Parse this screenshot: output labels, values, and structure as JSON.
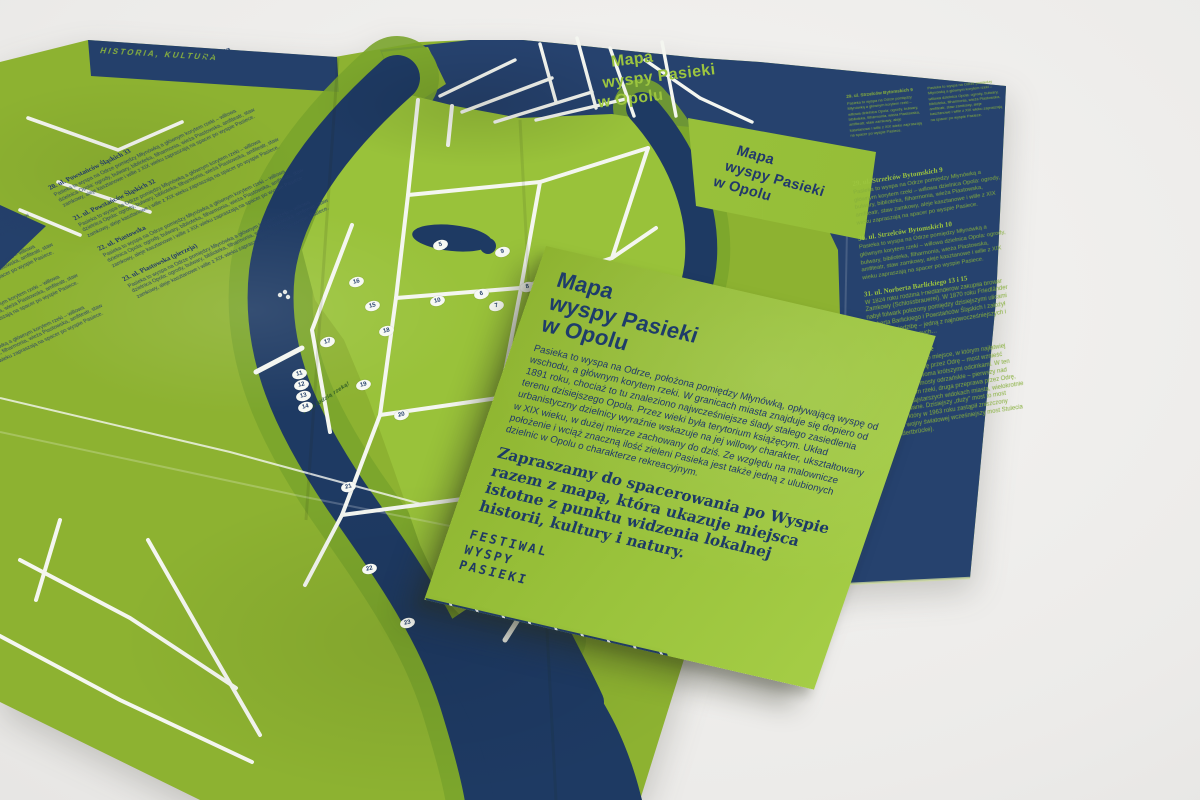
{
  "scene": {
    "background": "#ecebe9",
    "paper_green": "#8db231",
    "paper_green_bright": "#9ac33c",
    "paper_navy": "#24406b",
    "river_navy": "#1e3a63",
    "road_white": "#f4f6f0",
    "text_navy": "#1d3a66",
    "text_green": "#9cc53f"
  },
  "big_map": {
    "spine_heading": "HISTORIA, KULTURA",
    "natura_heading": "Natura",
    "back_title": {
      "l1": "Mapa",
      "l2": "wyspy Pasieki",
      "l3": "w Opolu"
    },
    "river_note": "Płyń łodzią rzeką!",
    "micro_text": "Pasieka to wyspa na Odrze pomiędzy Młynówką a głównym korytem rzeki – willowa dzielnica Opola: ogrody, bulwary, biblioteka, filharmonia, wieża Piastowska, amfiteatr, staw zamkowy, aleje kasztanowe i wille z XIX wieku zapraszają na spacer po wyspie Pasiece.",
    "left_entries": [
      {
        "heading": "15. ul. …"
      },
      {
        "heading": "16. ul. …"
      },
      {
        "heading": "17. ul. …"
      },
      {
        "heading": "18. ul. …"
      },
      {
        "heading": "20. ul. Powstańców Śląskich 33"
      },
      {
        "heading": "21. ul. Powstańców Śląskich 32"
      },
      {
        "heading": "22. ul. Piastowska"
      },
      {
        "heading": "23. ul. Piastowska (pierzeja)"
      }
    ]
  },
  "folded_map": {
    "title": {
      "l1": "Mapa",
      "l2": "wyspy Pasieki",
      "l3": "w Opolu"
    },
    "entries": [
      {
        "heading": "29. ul. Strzelców Bytomskich 9"
      },
      {
        "heading": "30. ul. Strzelców Bytomskich 10"
      },
      {
        "heading": "31. ul. Norberta Barlickiego 13 i 15",
        "body": "W 1824 roku rodzina Friedländerów zakupiła browar Zamkowy (Schlossbrauerei). W 1870 roku Friedländer nabył folwark położony pomiędzy dzisiejszymi ulicami Norberta Barlickiego i Powstańców Śląskich i założył tam nową siedzibę – jedną z najnowocześniejszych i najlepiej wyposażonych…"
      },
      {
        "heading": "32. Mosty odrzańskie",
        "body": "Wąski cypel Pasieki to miejsce, w którym najłatwiej budowano przeprawę przez Odrę – most wznieść można było nad dwoma krótszymi odcinkami. W ten sposób powstały mosty odrzańskie – pierwszy nad głównym korytem rzeki, druga przeprawa przez Odrę, widoczne na najstarszych widokach miasta, wielokrotnie przebudowywane. Dzisiejszy „duży” most to most Piastowski, który w 1963 roku zastąpił zniszczony podczas II wojny światowej wcześniejszy most Stulecia (Jahrhundertbrücke)."
      }
    ]
  },
  "cover_card": {
    "title": {
      "l1": "Mapa",
      "l2": "wyspy Pasieki",
      "l3": "w Opolu"
    },
    "intro": "Pasieka to wyspa na Odrze, położona pomiędzy Młynówką, opływającą wyspę od wschodu, a głównym korytem rzeki. W granicach miasta znajduje się dopiero od 1891 roku, chociaż to tu znaleziono najwcześniejsze ślady stałego zasiedlenia terenu dzisiejszego Opola. Przez wieki była terytorium książęcym. Układ urbanistyczny dzielnicy wyraźnie wskazuje na jej willowy charakter, ukształtowany w XIX wieku, w dużej mierze zachowany do dziś. Ze względu na malownicze położenie i wciąż znaczną ilość zieleni Pasieka jest także jedną z ulubionych dzielnic w Opolu o charakterze rekreacyjnym.",
    "invitation": "Zapraszamy do spacerowania po Wyspie razem z mapą, która ukazuje miejsca istotne z punktu widzenia lokalnej historii, kultury i natury.",
    "logo": {
      "l1": "FESTIWAL",
      "l2": "WYSPY",
      "l3": "PASIEKI"
    }
  },
  "map": {
    "markers": [
      "5",
      "9",
      "6",
      "7",
      "8",
      "10",
      "16",
      "15",
      "17",
      "18",
      "11",
      "12",
      "13",
      "14",
      "19",
      "20",
      "21",
      "22",
      "23"
    ]
  }
}
